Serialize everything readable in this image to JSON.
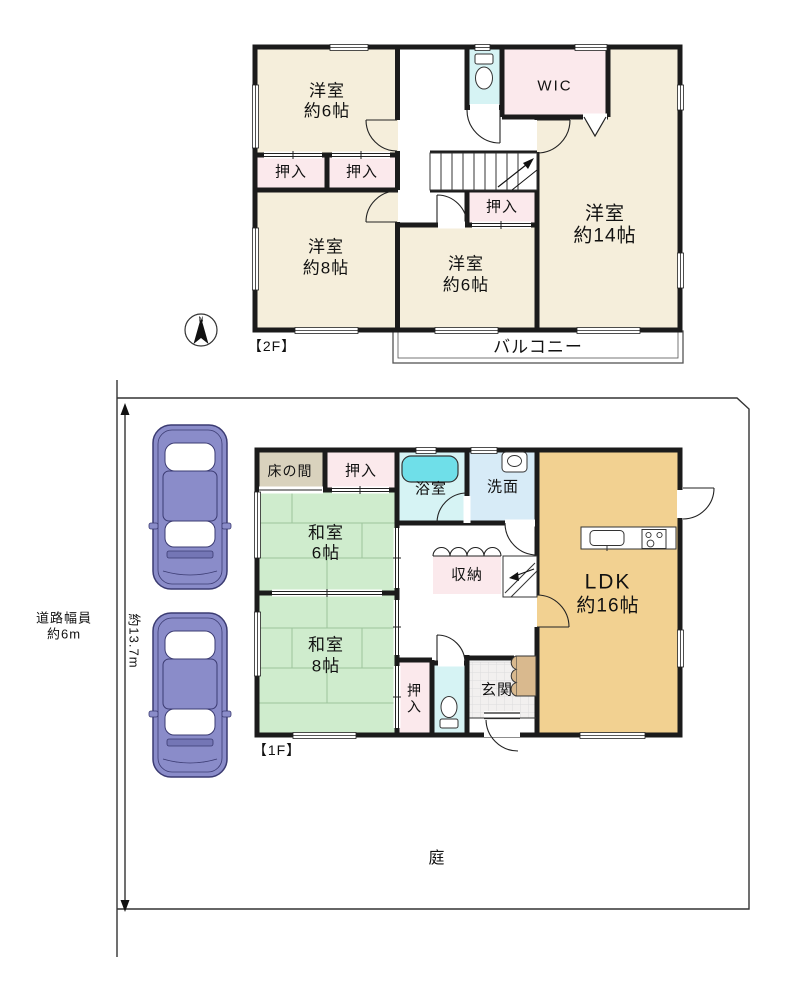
{
  "floor2": {
    "label": "【2F】",
    "room_a": {
      "name": "洋室",
      "size": "約6帖"
    },
    "room_b": {
      "name": "洋室",
      "size": "約8帖"
    },
    "room_c": {
      "name": "洋室",
      "size": "約6帖"
    },
    "room_d": {
      "name": "洋室",
      "size": "約14帖"
    },
    "wic": "WIC",
    "oshiire_a": "押入",
    "oshiire_b": "押入",
    "oshiire_c": "押入",
    "balcony": "バルコニー"
  },
  "floor1": {
    "label": "【1F】",
    "tokonoma": "床の間",
    "oshiire_top": "押入",
    "bath": "浴室",
    "washroom": "洗面",
    "washitsu6": {
      "name": "和室",
      "size": "6帖"
    },
    "storage": "収納",
    "ldk": {
      "name": "LDK",
      "size": "約16帖"
    },
    "washitsu8": {
      "name": "和室",
      "size": "8帖"
    },
    "oshiire_bottom": "押入",
    "entrance": "玄関",
    "garden": "庭"
  },
  "site": {
    "road_width_line1": "道路幅員",
    "road_width_line2": "約6m",
    "site_depth": "約13.7m",
    "compass_north": "N"
  },
  "colors": {
    "wall": "#1b1b1b",
    "western_room": "#f5eedb",
    "closet_pink": "#fbe9ec",
    "sanitary_cyan": "#d6f3f4",
    "bathtub": "#6fdfe9",
    "washroom_blue": "#d7ebf7",
    "tatami_green": "#cfeccd",
    "ldk_tan": "#f2d191",
    "tokonoma_beige": "#d9d2bd",
    "car_body": "#8a8cc9"
  }
}
